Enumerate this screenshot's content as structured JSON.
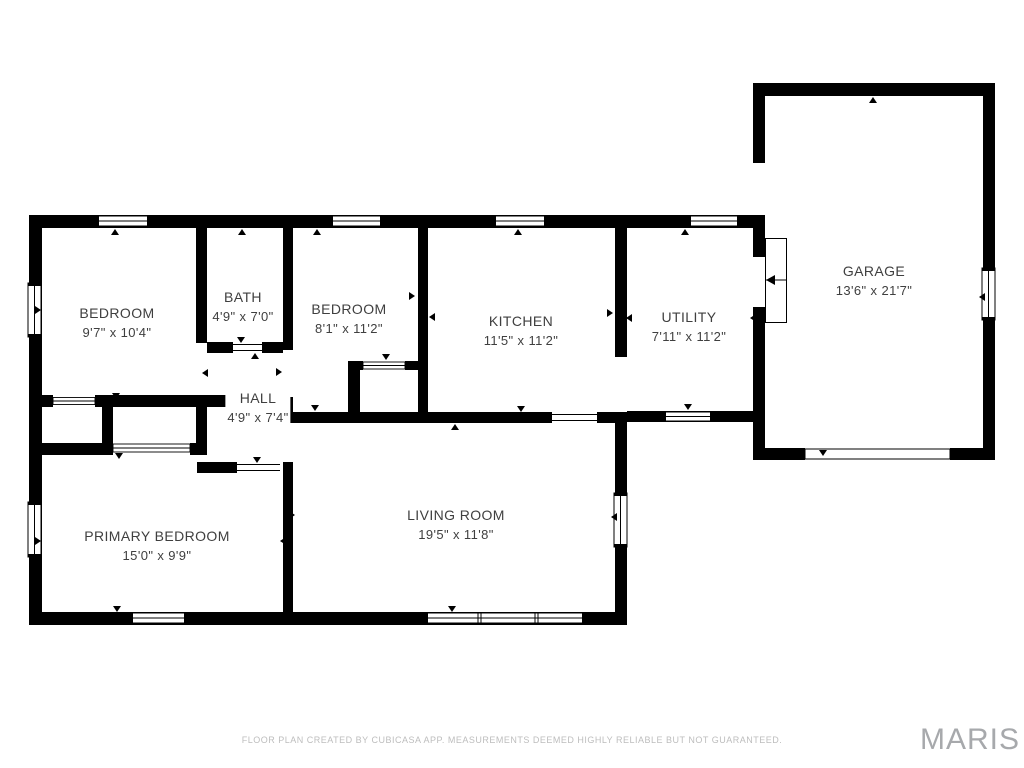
{
  "rooms": [
    {
      "name": "BEDROOM",
      "dims": "9'7\" x 10'4\""
    },
    {
      "name": "BATH",
      "dims": "4'9\" x 7'0\""
    },
    {
      "name": "BEDROOM",
      "dims": "8'1\" x 11'2\""
    },
    {
      "name": "KITCHEN",
      "dims": "11'5\" x 11'2\""
    },
    {
      "name": "UTILITY",
      "dims": "7'11\" x 11'2\""
    },
    {
      "name": "GARAGE",
      "dims": "13'6\" x 21'7\""
    },
    {
      "name": "HALL",
      "dims": "4'9\" x 7'4\""
    },
    {
      "name": "PRIMARY BEDROOM",
      "dims": "15'0\" x 9'9\""
    },
    {
      "name": "LIVING ROOM",
      "dims": "19'5\" x 11'8\""
    }
  ],
  "footer": {
    "disclaimer": "FLOOR PLAN CREATED BY CUBICASA APP. MEASUREMENTS DEEMED HIGHLY RELIABLE BUT NOT GUARANTEED."
  },
  "watermark": {
    "text": "MARIS"
  },
  "colors": {
    "wall": "#000000",
    "background": "#ffffff",
    "room_label_text": "#3f3f3f",
    "footer_text": "#bdbdbd",
    "watermark_text": "#a7a9ac"
  }
}
